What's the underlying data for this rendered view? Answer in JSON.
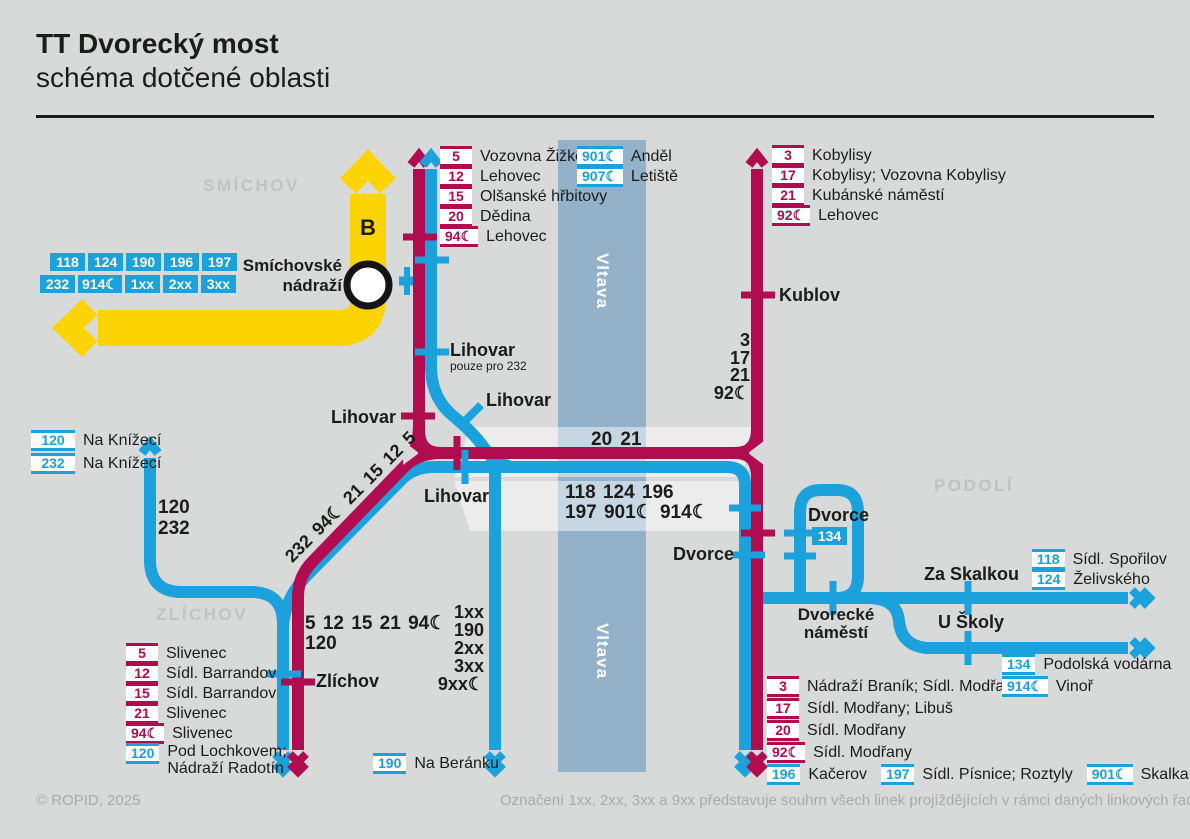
{
  "header": {
    "title": "TT Dvorecký most",
    "subtitle": "schéma dotčené oblasti"
  },
  "areas": {
    "smichov": "SMÍCHOV",
    "zlichov": "ZLÍCHOV",
    "podoli": "PODOLÍ"
  },
  "river": {
    "label": "Vltava"
  },
  "metro": {
    "line_letter": "B",
    "station_line1": "Smíchovské",
    "station_line2": "nádraží",
    "badges_row1": [
      "118",
      "124",
      "190",
      "196",
      "197"
    ],
    "badges_row2": [
      "232",
      "914☾",
      "1xx",
      "2xx",
      "3xx"
    ]
  },
  "stations": {
    "lihovar": "Lihovar",
    "lihovar_note": "pouze pro 232",
    "kublov": "Kublov",
    "zlichov": "Zlíchov",
    "dvorce": "Dvorce",
    "dvorce_loop": "Dvorce",
    "dvorce_loop_badge": "134",
    "dvorecke_namesti_line1": "Dvorecké",
    "dvorecke_namesti_line2": "náměstí",
    "za_skalkou": "Za Skalkou",
    "u_skoly": "U Školy"
  },
  "route_annotations": {
    "west_line1": "120",
    "west_line2": "232",
    "diagonal": "232 94☾ 21 15 12 5",
    "zlichov_line1": "5 12 15 21 94☾",
    "zlichov_line2": "120",
    "kublov": [
      "3",
      "17",
      "21",
      "92☾"
    ],
    "beranku": [
      "1xx",
      "190",
      "2xx",
      "3xx",
      "9xx☾"
    ],
    "bridge_tram": "20 21",
    "bridge_bus_line1": "118 124 196",
    "bridge_bus_line2": "197 901☾ 914☾"
  },
  "lists": {
    "north_tram": [
      {
        "badge": "5",
        "dest": "Vozovna Žižkov"
      },
      {
        "badge": "12",
        "dest": "Lehovec"
      },
      {
        "badge": "15",
        "dest": "Olšanské hřbitovy"
      },
      {
        "badge": "20",
        "dest": "Dědina"
      },
      {
        "badge": "94☾",
        "dest": "Lehovec"
      }
    ],
    "north_bus": [
      {
        "badge": "901☾",
        "dest": "Anděl"
      },
      {
        "badge": "907☾",
        "dest": "Letiště"
      }
    ],
    "northeast_tram": [
      {
        "badge": "3",
        "dest": "Kobylisy"
      },
      {
        "badge": "17",
        "dest": "Kobylisy; Vozovna Kobylisy"
      },
      {
        "badge": "21",
        "dest": "Kubánské náměstí"
      },
      {
        "badge": "92☾",
        "dest": "Lehovec"
      }
    ],
    "west_bus": [
      {
        "badge": "120",
        "dest": "Na Knížecí"
      },
      {
        "badge": "232",
        "dest": "Na Knížecí"
      }
    ],
    "southwest": [
      {
        "badge": "5",
        "dest": "Slivenec"
      },
      {
        "badge": "12",
        "dest": "Sídl. Barrandov"
      },
      {
        "badge": "15",
        "dest": "Sídl. Barrandov"
      },
      {
        "badge": "21",
        "dest": "Slivenec"
      },
      {
        "badge": "94☾",
        "dest": "Slivenec"
      },
      {
        "badge": "120",
        "dest": "Pod Lochkovem; Nádraží Radotín"
      }
    ],
    "southeast_tram": [
      {
        "badge": "3",
        "dest": "Nádraží Braník; Sídl. Modřany"
      },
      {
        "badge": "17",
        "dest": "Sídl. Modřany; Libuš"
      },
      {
        "badge": "20",
        "dest": "Sídl. Modřany"
      },
      {
        "badge": "92☾",
        "dest": "Sídl. Modřany"
      }
    ],
    "southeast_bus": [
      {
        "badge": "196",
        "dest": "Kačerov"
      },
      {
        "badge": "197",
        "dest": "Sídl. Písnice; Roztyly"
      },
      {
        "badge": "901☾",
        "dest": "Skalka"
      }
    ],
    "east_upper": [
      {
        "badge": "118",
        "dest": "Sídl. Spořilov"
      },
      {
        "badge": "124",
        "dest": "Želivského"
      }
    ],
    "east_lower": [
      {
        "badge": "134",
        "dest": "Podolská vodárna"
      },
      {
        "badge": "914☾",
        "dest": "Vinoř"
      }
    ],
    "beranku": {
      "badge": "190",
      "dest": "Na Beránku"
    }
  },
  "footer": {
    "copyright": "© ROPID, 2025",
    "note": "Označení 1xx, 2xx, 3xx a 9xx představuje souhrn všech linek projíždějících v rámci daných linkových řad."
  },
  "colors": {
    "tram": "#b00d50",
    "bus": "#1ba2dc",
    "metro_b": "#fcd303",
    "river": "#93b2ca",
    "background": "#d8dad9"
  }
}
